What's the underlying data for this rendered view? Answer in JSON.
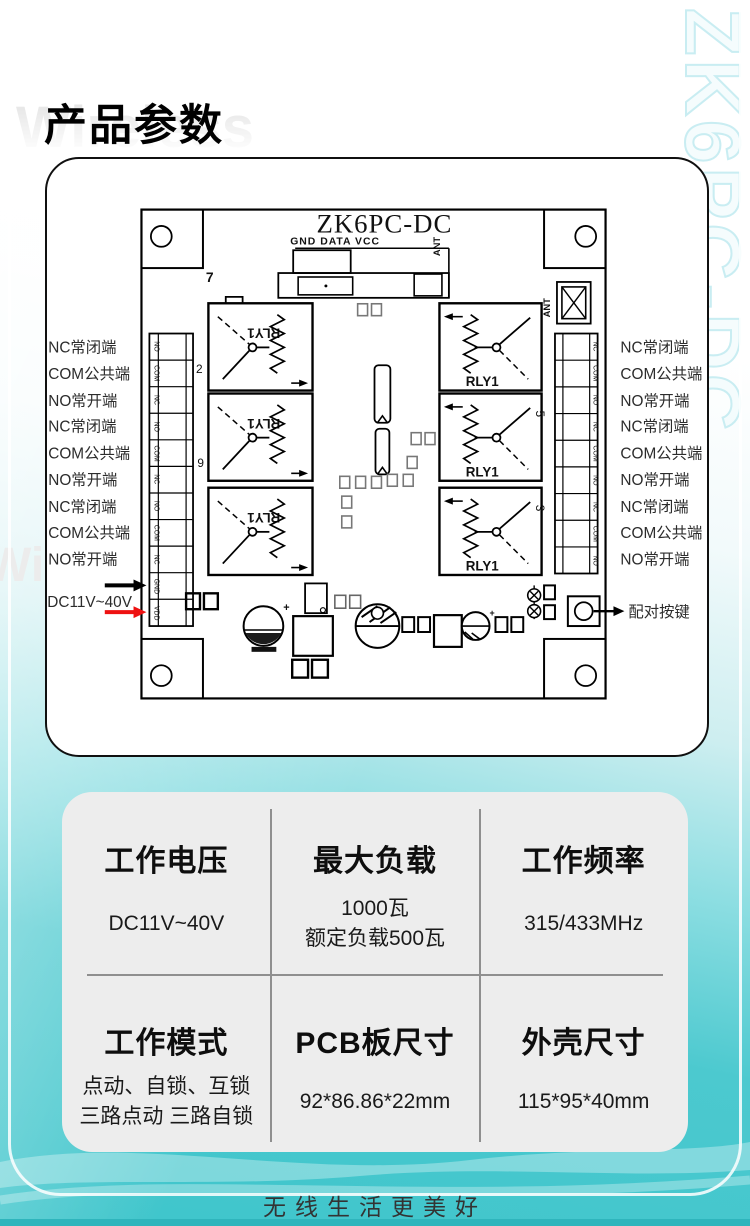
{
  "page": {
    "title": "产品参数",
    "watermark_wireless": "Wireless",
    "watermark_vertical": "ZK6PC-DC",
    "footer": "无线生活更美好"
  },
  "colors": {
    "teal": "#40c5cb",
    "card_gray": "#ededed",
    "accent_red": "#ee1111"
  },
  "pcb": {
    "board_title": "ZK6PC-DC",
    "header_pins": "GND DATA VCC",
    "ant": "ANT",
    "dip_on": "ON",
    "dip_12": "1 2",
    "n7": "7",
    "n2": "2",
    "n6": "6",
    "n5": "5",
    "n3": "3",
    "relay": "RLY1",
    "left_pins": [
      "NO",
      "COM",
      "NC",
      "NO",
      "COM",
      "NC",
      "NO",
      "COM",
      "NC",
      "GND",
      "VDD"
    ],
    "right_pins": [
      "NC",
      "COM",
      "NO",
      "NC",
      "COM",
      "NO",
      "NC",
      "COM",
      "NO"
    ],
    "left_labels": [
      "NC常闭端",
      "COM公共端",
      "NO常开端",
      "NC常闭端",
      "COM公共端",
      "NO常开端",
      "NC常闭端",
      "COM公共端",
      "NO常开端"
    ],
    "right_labels": [
      "NC常闭端",
      "COM公共端",
      "NO常开端",
      "NC常闭端",
      "COM公共端",
      "NO常开端",
      "NC常闭端",
      "COM公共端",
      "NO常开端"
    ],
    "power": "DC11V~40V",
    "pair": "配对按键"
  },
  "specs": {
    "cells": [
      {
        "title": "工作电压",
        "lines": [
          "DC11V~40V"
        ]
      },
      {
        "title": "最大负载",
        "lines": [
          "1000瓦",
          "额定负载500瓦"
        ]
      },
      {
        "title": "工作频率",
        "lines": [
          "315/433MHz"
        ]
      },
      {
        "title": "工作模式",
        "lines": [
          "点动、自锁、互锁",
          "三路点动 三路自锁"
        ]
      },
      {
        "title": "PCB板尺寸",
        "lines": [
          "92*86.86*22mm"
        ]
      },
      {
        "title": "外壳尺寸",
        "lines": [
          "115*95*40mm"
        ]
      }
    ]
  }
}
